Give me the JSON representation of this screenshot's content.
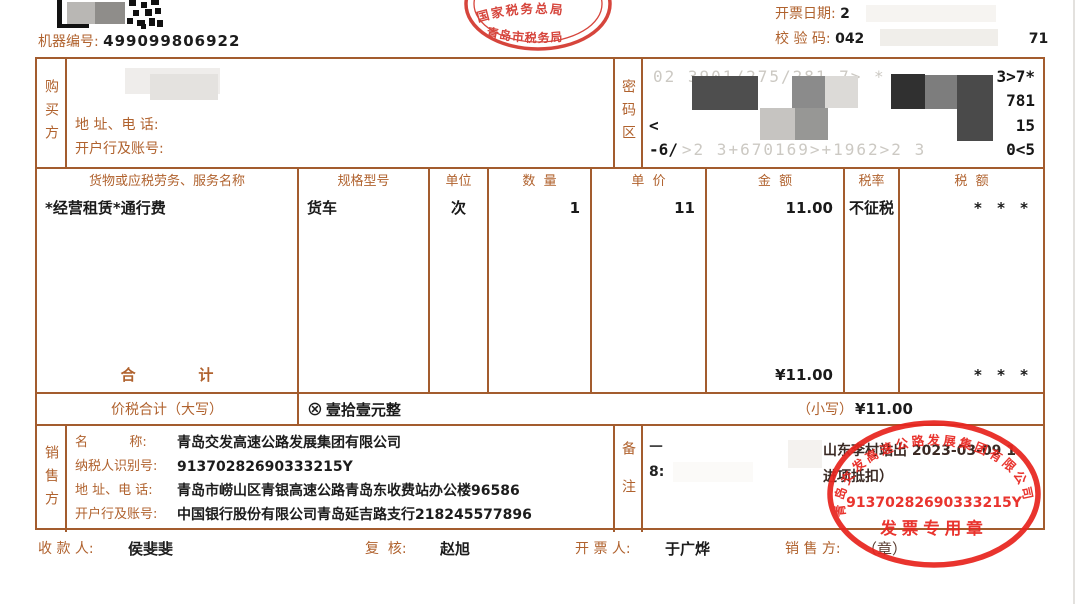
{
  "header": {
    "machine_label": "机器编号:",
    "machine_no": "499099806922",
    "stamp_top": "国家税务总局",
    "stamp_bottom": "青岛市税务局",
    "date_label": "开票日期:",
    "date_visible": "2",
    "check_label": "校 验 码:",
    "check_prefix": "042",
    "check_suffix": "71"
  },
  "buyer": {
    "label": "购买方",
    "address_label": "地 址、电 话:",
    "bank_label": "开户行及账号:"
  },
  "password": {
    "label": "密码区",
    "lines": [
      {
        "left": "",
        "faint": "02  3901/275/281  7>  *",
        "right": "3>7*"
      },
      {
        "left": "",
        "faint": "",
        "right": "781"
      },
      {
        "left": "<",
        "faint": "",
        "right": "15"
      },
      {
        "left": "-6/",
        "faint": ">2 3+670169>+1962>2 3",
        "right": "0<5"
      }
    ]
  },
  "table": {
    "headers": [
      "货物或应税劳务、服务名称",
      "规格型号",
      "单位",
      "数  量",
      "单  价",
      "金  额",
      "税率",
      "税  额"
    ],
    "row": [
      "*经营租赁*通行费",
      "货车",
      "次",
      "1",
      "11",
      "11.00",
      "不征税",
      "* * *"
    ],
    "total_label": "合            计",
    "total_amount": "¥11.00",
    "total_tax": "* * *"
  },
  "subtotal": {
    "label": "价税合计（大写）",
    "symbol": "⊗",
    "amount_cn": "壹拾壹元整",
    "small_label": "（小写）",
    "small_value": "¥11.00"
  },
  "seller": {
    "label": "销售方",
    "name_label": "名          称:",
    "name": "青岛交发高速公路发展集团有限公司",
    "tax_label": "纳税人识别号:",
    "tax_id": "91370282690333215Y",
    "address_label": "地 址、电 话:",
    "address": "青岛市崂山区青银高速公路青岛东收费站办公楼96586",
    "bank_label": "开户行及账号:",
    "bank": "中国银行股份有限公司青岛延吉路支行218245577896"
  },
  "remark": {
    "label": "备注",
    "line1_prefix": "—",
    "line1": "山东李村站出 2023-03-09 1",
    "line2_prefix": "8:",
    "line2": "进项抵扣）"
  },
  "seal": {
    "company": "青岛交发高速公路发展集团有限公司",
    "tax_id": "91370282690333215Y",
    "caption": "发票专用章"
  },
  "footer": {
    "payee_label": "收 款 人:",
    "payee": "侯斐斐",
    "review_label": "复  核:",
    "reviewer": "赵旭",
    "drawer_label": "开 票 人:",
    "drawer": "于广烨",
    "seller_label": "销 售 方:",
    "seller_value": "（章）"
  },
  "colors": {
    "border": "#a35c2e",
    "label": "#b0622e",
    "seal_red": "#e8251f"
  }
}
